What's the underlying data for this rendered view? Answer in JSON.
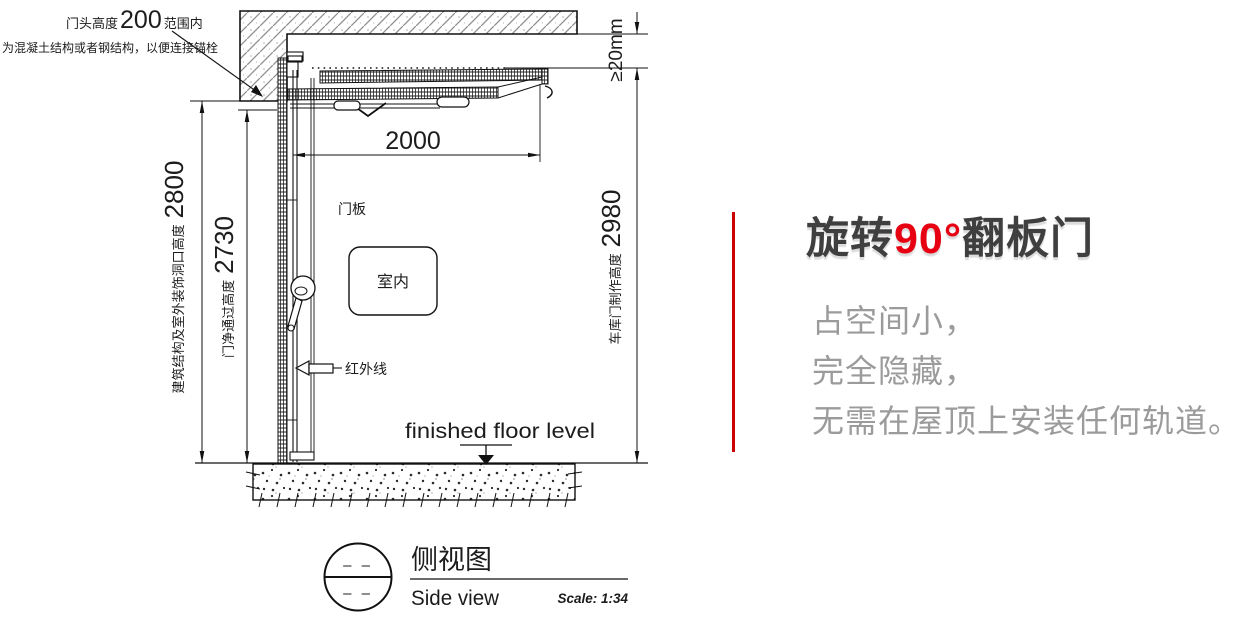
{
  "drawing": {
    "notes": {
      "head_prefix": "门头高度",
      "head_number": "200",
      "head_suffix": "范围内",
      "head_line2": "为混凝土结构或者钢结构，以便连接锚栓",
      "panel_label": "门板",
      "indoor_label": "室内",
      "infrared_label": "红外线",
      "floor_level_label": "finished floor level"
    },
    "dimensions": {
      "top_gap": "≥20mm",
      "panel_length": "2000",
      "opening_label": "建筑结构及室外装饰洞口高度",
      "opening_value": "2800",
      "clear_label": "门净通过高度",
      "clear_value": "2730",
      "door_label": "车库门制作高度",
      "door_value": "2980"
    },
    "title_block": {
      "title_cn": "侧视图",
      "title_en": "Side view",
      "scale": "Scale: 1:34",
      "dash_top": "– –",
      "dash_bottom": "– –"
    }
  },
  "panel": {
    "title_part1": "旋转",
    "title_part2": "90°",
    "title_part3": "翻板门",
    "features": [
      "占空间小，",
      "完全隐藏，",
      "无需在屋顶上安装任何轨道。"
    ]
  },
  "colors": {
    "accent_red": "#e60012",
    "divider_red": "#cc0001",
    "title_gray": "#3f3f3f",
    "body_gray": "#9b9b9b",
    "line_black": "#1c1c1c"
  }
}
